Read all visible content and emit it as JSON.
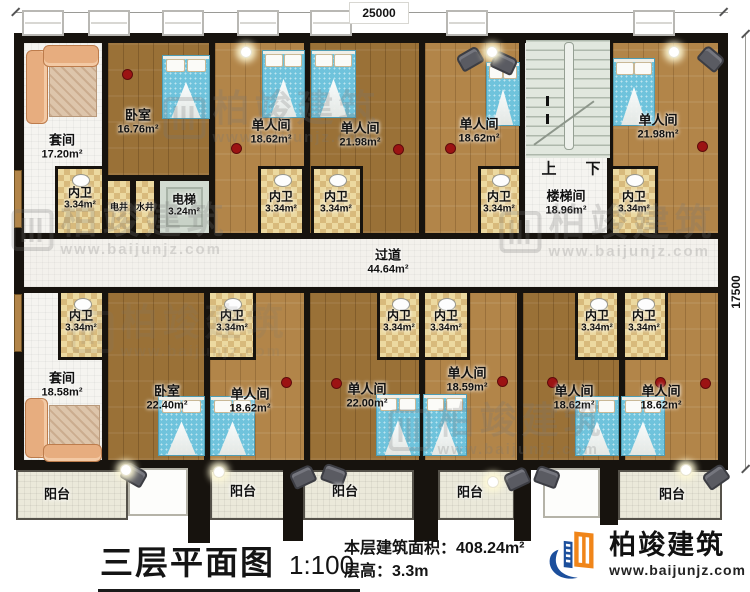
{
  "plan": {
    "dim_top": "25000",
    "dim_right": "17500",
    "spaces": [
      {
        "n": "套间",
        "a": "17.20m²",
        "x": 21,
        "y": 40,
        "w": 84,
        "h": 196,
        "lx": 62,
        "ly": 147,
        "f": "white",
        "s": "lg"
      },
      {
        "n": "卧室",
        "a": "16.76m²",
        "x": 105,
        "y": 40,
        "w": 107,
        "h": 138,
        "lx": 138,
        "ly": 122,
        "f": "wood-d",
        "s": "lg"
      },
      {
        "n": "电井",
        "a": "",
        "x": 105,
        "y": 178,
        "w": 28,
        "h": 58,
        "lx": 119,
        "ly": 207,
        "f": "tile",
        "s": "xs"
      },
      {
        "n": "水井",
        "a": "",
        "x": 133,
        "y": 178,
        "w": 24,
        "h": 58,
        "lx": 145,
        "ly": 207,
        "f": "tile",
        "s": "xs"
      },
      {
        "n": "电梯",
        "a": "3.24m²",
        "x": 157,
        "y": 178,
        "w": 55,
        "h": 58,
        "lx": 184,
        "ly": 206,
        "f": "elev",
        "s": "sm"
      },
      {
        "n": "单人间",
        "a": "18.62m²",
        "x": 212,
        "y": 40,
        "w": 95,
        "h": 196,
        "lx": 271,
        "ly": 132,
        "f": "wood-l",
        "s": "lg"
      },
      {
        "n": "单人间",
        "a": "21.98m²",
        "x": 307,
        "y": 40,
        "w": 115,
        "h": 196,
        "lx": 360,
        "ly": 135,
        "f": "wood-d",
        "s": "lg"
      },
      {
        "n": "单人间",
        "a": "18.62m²",
        "x": 422,
        "y": 40,
        "w": 100,
        "h": 196,
        "lx": 479,
        "ly": 131,
        "f": "wood-l",
        "s": "lg"
      },
      {
        "n": "楼梯间",
        "a": "18.96m²",
        "x": 522,
        "y": 40,
        "w": 88,
        "h": 196,
        "lx": 566,
        "ly": 203,
        "f": "white",
        "s": "lg"
      },
      {
        "n": "单人间",
        "a": "21.98m²",
        "x": 610,
        "y": 40,
        "w": 111,
        "h": 196,
        "lx": 658,
        "ly": 127,
        "f": "wood-l",
        "s": "lg"
      },
      {
        "n": "过道",
        "a": "44.64m²",
        "x": 21,
        "y": 236,
        "w": 700,
        "h": 54,
        "lx": 388,
        "ly": 262,
        "f": "corridor",
        "s": "lg"
      },
      {
        "n": "套间",
        "a": "18.58m²",
        "x": 21,
        "y": 290,
        "w": 84,
        "h": 173,
        "lx": 62,
        "ly": 385,
        "f": "white",
        "s": "lg"
      },
      {
        "n": "卧室",
        "a": "22.40m²",
        "x": 105,
        "y": 290,
        "w": 102,
        "h": 173,
        "lx": 167,
        "ly": 398,
        "f": "wood-d",
        "s": "lg"
      },
      {
        "n": "单人间",
        "a": "18.62m²",
        "x": 207,
        "y": 290,
        "w": 100,
        "h": 173,
        "lx": 250,
        "ly": 401,
        "f": "wood-l",
        "s": "lg"
      },
      {
        "n": "单人间",
        "a": "22.00m²",
        "x": 307,
        "y": 290,
        "w": 115,
        "h": 173,
        "lx": 367,
        "ly": 396,
        "f": "wood-d",
        "s": "lg"
      },
      {
        "n": "单人间",
        "a": "18.59m²",
        "x": 422,
        "y": 290,
        "w": 98,
        "h": 173,
        "lx": 467,
        "ly": 380,
        "f": "wood-l",
        "s": "lg"
      },
      {
        "n": "单人间",
        "a": "18.62m²",
        "x": 520,
        "y": 290,
        "w": 102,
        "h": 173,
        "lx": 574,
        "ly": 398,
        "f": "wood-d",
        "s": "lg"
      },
      {
        "n": "单人间",
        "a": "18.62m²",
        "x": 622,
        "y": 290,
        "w": 99,
        "h": 173,
        "lx": 661,
        "ly": 398,
        "f": "wood-l",
        "s": "lg"
      },
      {
        "n": "内卫",
        "a": "3.34m²",
        "x": 55,
        "y": 166,
        "w": 50,
        "h": 70,
        "lx": 80,
        "ly": 199,
        "f": "tile",
        "s": "sm"
      },
      {
        "n": "内卫",
        "a": "3.34m²",
        "x": 258,
        "y": 166,
        "w": 47,
        "h": 70,
        "lx": 281,
        "ly": 203,
        "f": "tile",
        "s": "sm"
      },
      {
        "n": "内卫",
        "a": "3.34m²",
        "x": 311,
        "y": 166,
        "w": 52,
        "h": 70,
        "lx": 336,
        "ly": 203,
        "f": "tile",
        "s": "sm"
      },
      {
        "n": "内卫",
        "a": "3.34m²",
        "x": 478,
        "y": 166,
        "w": 44,
        "h": 70,
        "lx": 499,
        "ly": 203,
        "f": "tile",
        "s": "sm"
      },
      {
        "n": "内卫",
        "a": "3.34m²",
        "x": 610,
        "y": 166,
        "w": 48,
        "h": 70,
        "lx": 634,
        "ly": 203,
        "f": "tile",
        "s": "sm"
      },
      {
        "n": "内卫",
        "a": "3.34m²",
        "x": 58,
        "y": 290,
        "w": 47,
        "h": 70,
        "lx": 81,
        "ly": 322,
        "f": "tile",
        "s": "sm"
      },
      {
        "n": "内卫",
        "a": "3.34m²",
        "x": 207,
        "y": 290,
        "w": 49,
        "h": 70,
        "lx": 232,
        "ly": 322,
        "f": "tile",
        "s": "sm"
      },
      {
        "n": "内卫",
        "a": "3.34m²",
        "x": 377,
        "y": 290,
        "w": 45,
        "h": 70,
        "lx": 399,
        "ly": 322,
        "f": "tile",
        "s": "sm"
      },
      {
        "n": "内卫",
        "a": "3.34m²",
        "x": 422,
        "y": 290,
        "w": 48,
        "h": 70,
        "lx": 446,
        "ly": 322,
        "f": "tile",
        "s": "sm"
      },
      {
        "n": "内卫",
        "a": "3.34m²",
        "x": 575,
        "y": 290,
        "w": 45,
        "h": 70,
        "lx": 597,
        "ly": 322,
        "f": "tile",
        "s": "sm"
      },
      {
        "n": "内卫",
        "a": "3.34m²",
        "x": 622,
        "y": 290,
        "w": 46,
        "h": 70,
        "lx": 644,
        "ly": 322,
        "f": "tile",
        "s": "sm"
      },
      {
        "n": "阳台",
        "a": "",
        "x": 16,
        "y": 470,
        "w": 112,
        "h": 50,
        "lx": 57,
        "ly": 495,
        "f": "balcony",
        "s": "lg"
      },
      {
        "n": "阳台",
        "a": "",
        "x": 210,
        "y": 470,
        "w": 93,
        "h": 50,
        "lx": 243,
        "ly": 492,
        "f": "balcony",
        "s": "lg"
      },
      {
        "n": "阳台",
        "a": "",
        "x": 303,
        "y": 470,
        "w": 111,
        "h": 50,
        "lx": 345,
        "ly": 492,
        "f": "balcony",
        "s": "lg"
      },
      {
        "n": "阳台",
        "a": "",
        "x": 438,
        "y": 470,
        "w": 77,
        "h": 50,
        "lx": 470,
        "ly": 493,
        "f": "balcony",
        "s": "lg"
      },
      {
        "n": "阳台",
        "a": "",
        "x": 618,
        "y": 470,
        "w": 104,
        "h": 50,
        "lx": 672,
        "ly": 495,
        "f": "balcony",
        "s": "lg"
      },
      {
        "n": "",
        "a": "",
        "x": 128,
        "y": 468,
        "w": 60,
        "h": 48,
        "lx": 0,
        "ly": 0,
        "f": "porch",
        "s": "sm"
      },
      {
        "n": "",
        "a": "",
        "x": 543,
        "y": 468,
        "w": 57,
        "h": 50,
        "lx": 0,
        "ly": 0,
        "f": "porch",
        "s": "sm"
      }
    ],
    "stair_graphic": {
      "x": 526,
      "y": 40,
      "w": 84,
      "h": 118
    },
    "stair_marks": [
      {
        "t": "上",
        "x": 549,
        "y": 168
      },
      {
        "t": "下",
        "x": 593,
        "y": 168
      }
    ],
    "windows": {
      "y": 10,
      "w": 42,
      "h": 26,
      "xs": [
        22,
        88,
        162,
        237,
        310,
        446,
        633
      ]
    },
    "columns": [
      [
        188,
        463,
        22,
        80
      ],
      [
        283,
        463,
        20,
        78
      ],
      [
        414,
        463,
        24,
        78
      ],
      [
        514,
        463,
        17,
        78
      ],
      [
        600,
        463,
        18,
        62
      ]
    ],
    "doors": [
      [
        14,
        170,
        8,
        58
      ],
      [
        14,
        294,
        8,
        58
      ]
    ],
    "beds": [
      [
        162,
        55,
        48,
        64
      ],
      [
        262,
        50,
        43,
        68
      ],
      [
        311,
        50,
        45,
        68
      ],
      [
        486,
        62,
        34,
        64
      ],
      [
        613,
        58,
        42,
        68
      ],
      [
        158,
        396,
        47,
        60
      ],
      [
        210,
        396,
        45,
        60
      ],
      [
        376,
        394,
        44,
        62
      ],
      [
        423,
        394,
        44,
        62
      ],
      [
        575,
        396,
        44,
        60
      ],
      [
        621,
        396,
        44,
        60
      ]
    ],
    "chairs": [
      [
        458,
        50,
        -30
      ],
      [
        492,
        54,
        25
      ],
      [
        699,
        50,
        40
      ],
      [
        122,
        466,
        30
      ],
      [
        291,
        468,
        -25
      ],
      [
        322,
        466,
        20
      ],
      [
        505,
        470,
        -25
      ],
      [
        535,
        468,
        20
      ],
      [
        704,
        468,
        -35
      ]
    ],
    "dots": [
      [
        122,
        69
      ],
      [
        231,
        143
      ],
      [
        393,
        144
      ],
      [
        445,
        143
      ],
      [
        697,
        141
      ],
      [
        281,
        377
      ],
      [
        331,
        378
      ],
      [
        497,
        376
      ],
      [
        547,
        377
      ],
      [
        655,
        377
      ],
      [
        700,
        378
      ]
    ],
    "lamps": [
      [
        240,
        46
      ],
      [
        486,
        46
      ],
      [
        668,
        46
      ],
      [
        213,
        466
      ],
      [
        120,
        464
      ],
      [
        487,
        476
      ],
      [
        680,
        464
      ]
    ],
    "sofas": [
      {
        "x": 26,
        "y": 45,
        "w": 76,
        "h": 84,
        "corner": "tl"
      },
      {
        "x": 25,
        "y": 394,
        "w": 80,
        "h": 68,
        "corner": "bl"
      }
    ]
  },
  "watermark": {
    "name": "柏竣建筑",
    "url": "www.baijunjz.com"
  },
  "watermark_positions": [
    {
      "x": 272,
      "y": 118,
      "o": 0.24
    },
    {
      "x": 120,
      "y": 230,
      "o": 0.24
    },
    {
      "x": 608,
      "y": 232,
      "o": 0.24
    },
    {
      "x": 497,
      "y": 430,
      "o": 0.24
    },
    {
      "x": 180,
      "y": 332,
      "o": 0.14
    }
  ],
  "footer": {
    "title": "三层平面图",
    "scale": "1:100",
    "area_label": "本层建筑面积：",
    "area_value": "408.24m²",
    "floor_height_label": "层高：",
    "floor_height_value": "3.3m"
  },
  "logo": {
    "name": "柏竣建筑",
    "url": "www.baijunjz.com"
  },
  "colors": {
    "wall": "#17130e",
    "wood_light": "#b28549",
    "wood_dark": "#9a7137",
    "tile": "#ecd9a0",
    "tile_check": "#d8ba7c",
    "suite_floor": "#f5f4f0",
    "corridor": "#f3f1ec",
    "balcony": "#ebe9da",
    "elevator": "#d2dbd1",
    "stair": "#e1e7de",
    "bed_blue": "#6fc3dc",
    "accent_red": "#9c1313",
    "brand_blue": "#1c4f9c",
    "brand_orange": "#f08519",
    "watermark_gray": "#787878"
  }
}
